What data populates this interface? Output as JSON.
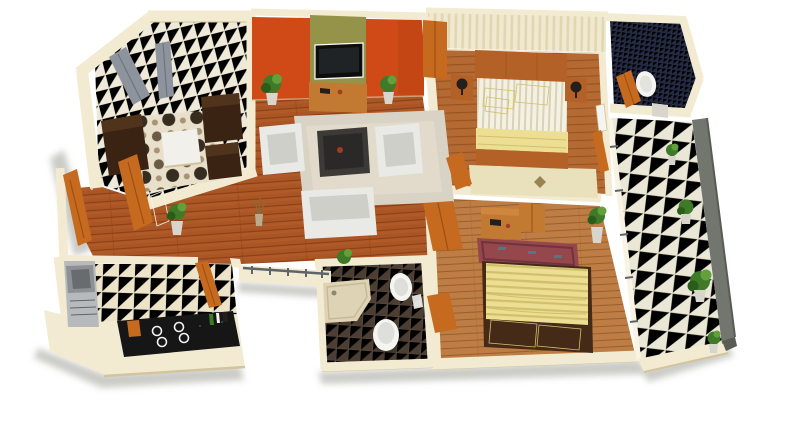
{
  "meta": {
    "description": "3D rendered isometric floor plan of a two-bedroom apartment on a white background: lounge, living room with TV wall, hallway, kitchen, bathroom, two bedrooms, ensuite and a tiled balcony with plants"
  },
  "colors": {
    "background": "#ffffff",
    "wall": "#f2ebd2",
    "wall_hi": "#f8f3e2",
    "wall_edge": "#d2c49c",
    "shadow": "#98978f",
    "accent_orange": "#cf4a17",
    "accent_orange_dark": "#a93c0e",
    "olive": "#949349",
    "wood_mid": "#b05a28",
    "wood_dark": "#8a3f15",
    "wood_mid2": "#b46a32",
    "wood_dark2": "#92511e",
    "wood_light": "#bd7d44",
    "wood_light_line": "#995f2c",
    "tile_cream": "#eee9d8",
    "tile_line": "#d9d2ba",
    "tile_kitchen": "#ece3c8",
    "tile_balcony": "#eae7d6",
    "tile_line2": "#d6d2bc",
    "bath_floor": "#4d3e33",
    "bath_line": "#5f5042",
    "navy": "#252b45",
    "navy_line": "#3c4569",
    "wallpaper": "#f0e9cf",
    "wallpaper_line": "#e1d6b2",
    "mattress": "#f4f1e3",
    "mattress_line": "#d8d2b8",
    "yellow": "#ecdf93",
    "yellow_dark": "#d2bf6c",
    "yellow_bright": "#f3ea9e",
    "door_orange": "#c56a1e",
    "door_orange_dark": "#9e4f12",
    "sofa_brown": "#3a2312",
    "sofa_brown_hi": "#5a3a20",
    "sofa_white": "#e9e9e6",
    "sofa_white_shade": "#cfcfc9",
    "table_dark": "#3b3a37",
    "table_dark_top": "#2a2927",
    "table_white": "#f1f0ea",
    "rug_light": "#d9d3c5",
    "rug_light2": "#e3ddcd",
    "rug_cream": "#e8e0ca",
    "circ1": "#6b5a44",
    "circ2": "#372c20",
    "circ3": "#a79376",
    "rug_bed1": "#e9e1bc",
    "ornament": "#8a7340",
    "rug_maroon": "#95474b",
    "rug_maroon_dark": "#6f3340",
    "rug_teal": "#4e7f86",
    "console_wood": "#c27a33",
    "bed_wood": "#b36127",
    "bed2_frame": "#452a18",
    "window_gray": "#8e949e",
    "window_gray_dark": "#6f7580",
    "parapet": "#73766f",
    "parapet_dark": "#595c55",
    "rail_metal": "#5f6468",
    "plant_green": "#3e7a28",
    "plant_dark": "#2a5c1a",
    "plant_hi": "#63a03c",
    "pot_light": "#d8d5cc",
    "pot_tan": "#b9ab8e",
    "steel": "#b7babd",
    "steel_dark": "#8d9194",
    "steel_deep": "#686c6f",
    "counter_black": "#161616",
    "counter_fleck": "#4a4a4a",
    "white_fix": "#f4f4f1",
    "white_fix_shade": "#dededa",
    "lamp_dark": "#241f1a",
    "item_red": "#a33b20"
  },
  "scene": {
    "view": "isometric-3d-floor-plan",
    "rooms": [
      {
        "name": "lounge",
        "floor": "cream-tile",
        "furniture": [
          "dark-brown-sofa",
          "two-dark-brown-armchairs",
          "white-coffee-table",
          "circle-pattern-rug",
          "two-gray-windows"
        ]
      },
      {
        "name": "living-room",
        "floor": "wood-plank",
        "furniture": [
          "orange-accent-wall",
          "olive-tv-panel",
          "flat-tv",
          "wood-media-console",
          "two-white-armchairs",
          "white-sofa",
          "dark-coffee-table",
          "shag-rug",
          "two-potted-plants"
        ]
      },
      {
        "name": "hallway",
        "floor": "wood-plank",
        "furniture": [
          "potted-plant",
          "open-orange-doors",
          "metal-railing"
        ]
      },
      {
        "name": "kitchen",
        "floor": "beige-tile",
        "furniture": [
          "stainless-sink-unit",
          "black-counter-with-four-burners",
          "orange-door"
        ]
      },
      {
        "name": "bathroom",
        "floor": "dark-tile",
        "furniture": [
          "corner-shower-tray",
          "toilet",
          "wall-sink",
          "ledge-plant"
        ]
      },
      {
        "name": "bedroom-1",
        "floor": "wood-plank",
        "furniture": [
          "double-bed-yellow-bedding",
          "two-nightstands-with-lamps",
          "orange-wardrobe",
          "cream-rug",
          "striped-wallpaper-wall"
        ]
      },
      {
        "name": "ensuite",
        "floor": "navy-mosaic",
        "furniture": [
          "oval-sink",
          "orange-door"
        ]
      },
      {
        "name": "bedroom-2",
        "floor": "light-wood-plank",
        "furniture": [
          "double-bed-yellow-striped-blanket",
          "wood-desk",
          "maroon-rug",
          "potted-plant",
          "orange-doors"
        ]
      },
      {
        "name": "balcony",
        "floor": "white-tile",
        "furniture": [
          "gray-parapet",
          "railing",
          "four-potted-plants"
        ]
      }
    ]
  }
}
